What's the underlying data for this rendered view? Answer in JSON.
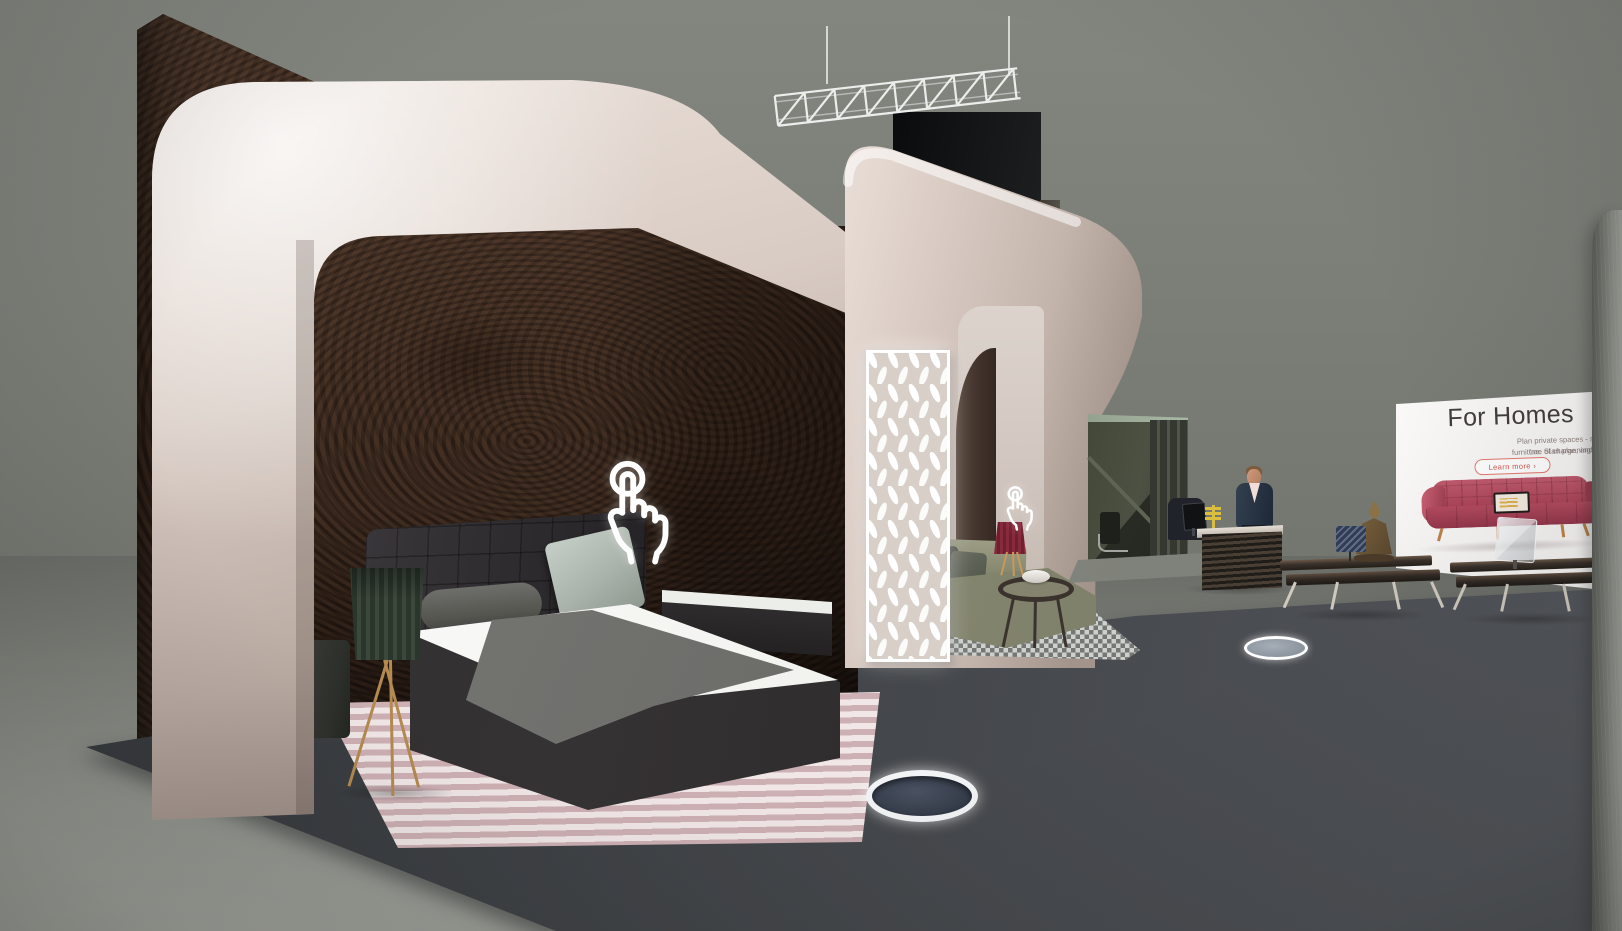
{
  "app": {
    "name": "virtual-showroom",
    "view": "3d-exhibition-stand"
  },
  "display_screen": {
    "title": "For Homes",
    "body_line1": "Plan private spaces - simple, free of charge, and so",
    "body_line2": "furniture. Start planning right aw",
    "cta_label": "Learn more ›"
  },
  "icons": {
    "bedroom_hotspot": "tap-hand-icon",
    "lounge_hotspot": "tap-hand-icon",
    "teleport_near": "teleport-disc",
    "teleport_far": "teleport-disc"
  },
  "colors": {
    "accent_red": "#d8554d",
    "arch_beige": "#d8cbc3",
    "wood_brown": "#3b2a20",
    "platform_gray": "#43464a",
    "wall_gray": "#7c7f78",
    "sofa_olive": "#8a8b73",
    "screen_sofa_red": "#b04a5e",
    "hotspot_white": "#ffffff"
  }
}
